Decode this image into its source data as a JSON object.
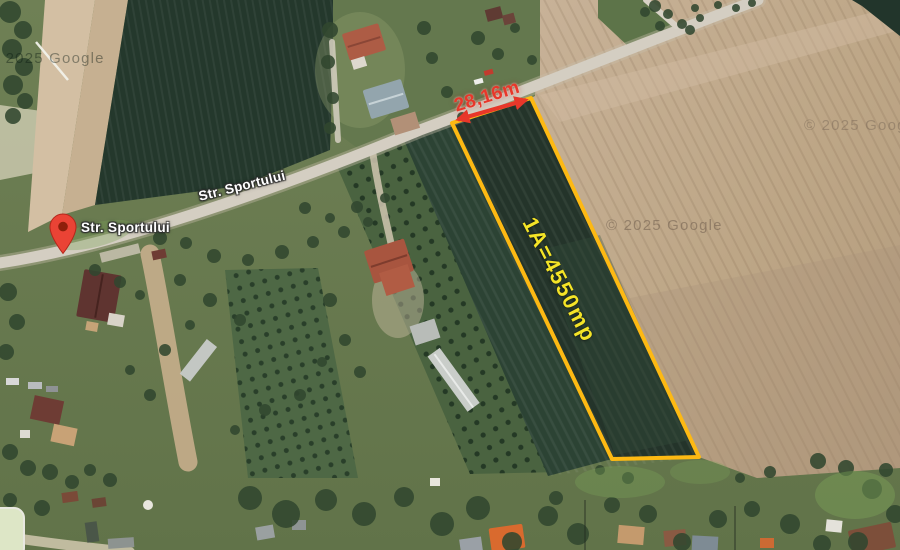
{
  "map": {
    "view": "satellite",
    "marker": {
      "label": "Str. Sportului",
      "icon": "map-pin"
    },
    "street": {
      "label": "Str. Sportului"
    },
    "parcel": {
      "width_label": "28,16m",
      "area_label": "1A=4550mp"
    },
    "watermarks": {
      "top_left": "© 2025 Google",
      "center": "© 2025 Google",
      "right": "© 2025 Google"
    },
    "colors": {
      "parcel_outline": "#fdb913",
      "measure_red": "#e8372a",
      "area_yellow": "#f4e427",
      "marker_red": "#ea4335",
      "label_white": "#ffffff"
    }
  }
}
